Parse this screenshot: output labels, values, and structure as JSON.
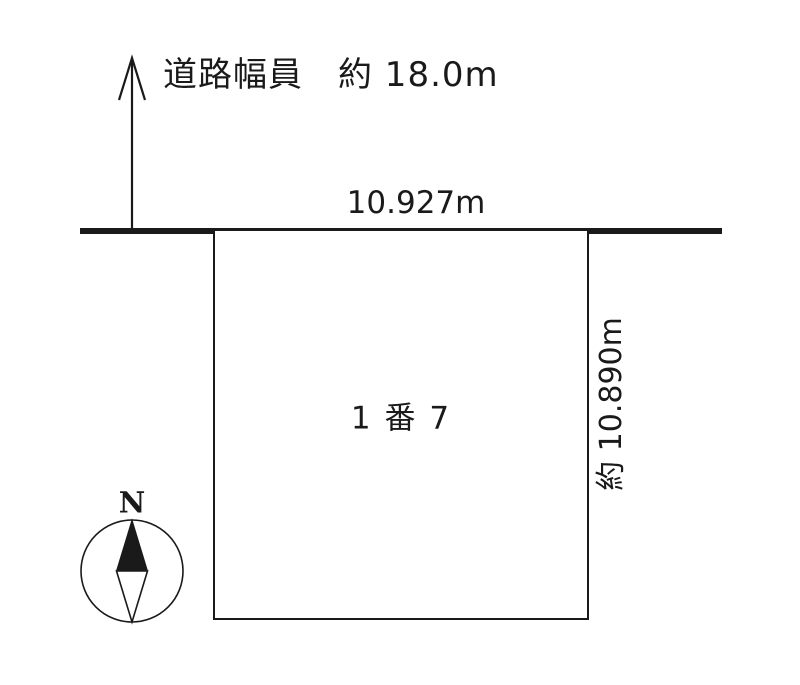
{
  "page": {
    "background_color": "#ffffff",
    "ink_color": "#1a1a1a"
  },
  "road": {
    "width_label": "道路幅員　約 18.0m",
    "frontage_label": "10.927m"
  },
  "plot": {
    "lot_label": "1 番 7",
    "depth_label": "約 10.890m"
  },
  "compass": {
    "north_label": "N"
  }
}
